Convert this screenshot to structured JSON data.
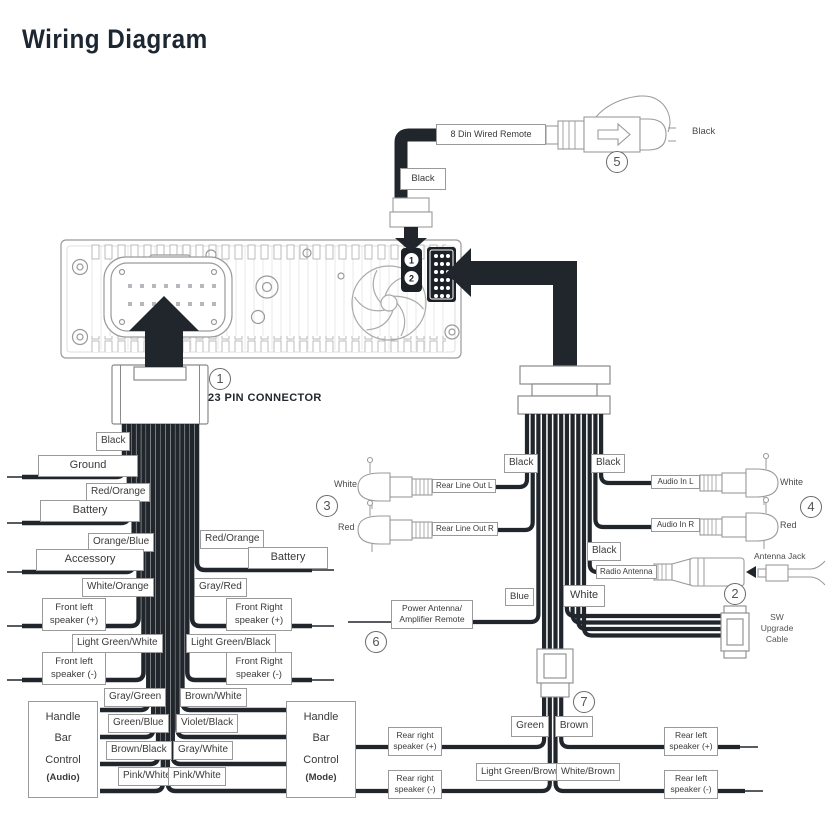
{
  "title": "Wiring Diagram",
  "callouts": {
    "one": "1",
    "two": "2",
    "three": "3",
    "four": "4",
    "five": "5",
    "six": "6",
    "seven": "7"
  },
  "head_unit": {
    "din_port_1": "1",
    "din_port_2": "2"
  },
  "pin_connector": {
    "label": "23 PIN CONNECTOR"
  },
  "remote": {
    "cable_label": "8 Din Wired Remote",
    "wire_color": "Black",
    "plug_color": "Black"
  },
  "left": {
    "ground_color": "Black",
    "ground": "Ground",
    "batt_l_color": "Red/Orange",
    "batt_l": "Battery",
    "acc_color": "Orange/Blue",
    "acc": "Accessory",
    "batt_r_color": "Red/Orange",
    "batt_r": "Battery",
    "fl_pos_color": "White/Orange",
    "fl_pos": "Front left speaker (+)",
    "fr_pos_color": "Gray/Red",
    "fr_pos": "Front Right speaker (+)",
    "fl_neg_color": "Light Green/White",
    "fl_neg": "Front left speaker (-)",
    "fr_neg_color": "Light Green/Black",
    "fr_neg": "Front Right speaker (-)",
    "audio_wires": [
      "Gray/Green",
      "Green/Blue",
      "Brown/Black",
      "Pink/White"
    ],
    "mode_wires": [
      "Brown/White",
      "Violet/Black",
      "Gray/White",
      "Pink/White"
    ],
    "handle_audio": {
      "title": "Handle Bar Control",
      "sub": "(Audio)"
    },
    "handle_mode": {
      "title": "Handle Bar Control",
      "sub": "(Mode)"
    }
  },
  "right": {
    "black_out": "Black",
    "black_in": "Black",
    "black_ant": "Black",
    "rlo_l": "Rear Line Out L",
    "rlo_l_plug": "White",
    "rlo_r": "Rear Line Out R",
    "rlo_r_plug": "Red",
    "ain_l": "Audio In L",
    "ain_l_plug": "White",
    "ain_r": "Audio In R",
    "ain_r_plug": "Red",
    "radio_ant": "Radio Antenna",
    "ant_jack": "Antenna Jack",
    "blue": "Blue",
    "pwr_ant": "Power Antenna/ Amplifier Remote",
    "white": "White",
    "sw": "SW Upgrade Cable",
    "rr_pos_color": "Green",
    "rr_pos": "Rear right speaker (+)",
    "rl_pos_color": "Brown",
    "rl_pos": "Rear left speaker (+)",
    "rr_neg_color": "Light Green/Brown",
    "rr_neg": "Rear right speaker (-)",
    "rl_neg_color": "White/Brown",
    "rl_neg": "Rear left speaker (-)"
  }
}
